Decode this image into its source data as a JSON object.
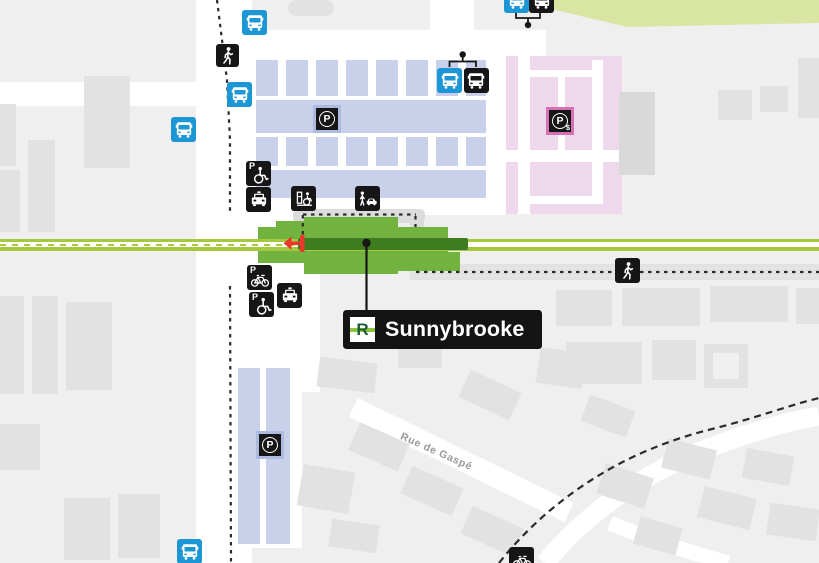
{
  "station": {
    "name": "Sunnybrooke",
    "line_letter": "R"
  },
  "streets": {
    "rue_de_gaspe": "Rue de Gaspé"
  },
  "parking": {
    "p_label": "P",
    "paid_suffix": "$"
  },
  "icons": {
    "bus_blue": "bus-icon-blue",
    "bus_black": "bus-icon-black",
    "pedestrian": "pedestrian-icon",
    "accessible_parking": "accessible-parking-icon",
    "taxi": "taxi-icon",
    "bike_parking": "bike-parking-icon",
    "bike_path": "bike-icon",
    "drop_off": "drop-off-icon",
    "boarding_assistance": "boarding-assistance-icon",
    "free_parking": "parking-icon",
    "paid_parking": "paid-parking-icon",
    "train_direction": "direction-arrow-icon",
    "station_marker": "station-dot"
  },
  "colors": {
    "background": "#efefef",
    "buildings": "#e2e2e2",
    "roads": "#ffffff",
    "rail_line": "#a4c93e",
    "rail_station_segment": "#3d7c21",
    "platform": "#72b33f",
    "bus_blue": "#1d96d5",
    "icon_black": "#161616",
    "free_parking_fill": "#c9d1ea",
    "paid_parking_fill": "#eed9ec",
    "paid_parking_accent": "#d76fb5",
    "direction_arrow": "#e8392b",
    "green_area": "#d9e5a2",
    "label_background": "#141414",
    "label_text": "#ffffff",
    "logo_letter_green": "#1d5c36",
    "logo_stripe_green": "#8cc63e"
  }
}
